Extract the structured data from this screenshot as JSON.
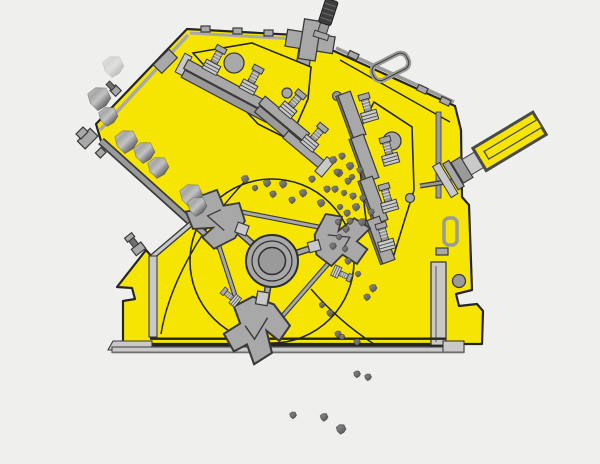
{
  "scene": {
    "width": 600,
    "height": 464,
    "description": "impact-crusher cross-section illustration",
    "background": "#efefee"
  },
  "colors": {
    "body_yellow": "#f6e502",
    "outline": "#252525",
    "metal": "#a8a8a8",
    "metal_light": "#c9c9c9",
    "metal_mid": "#9a9a9a",
    "metal_dark": "#6f6f6f",
    "metal_stroke": "#3a3a3a",
    "rod_dark": "#3d3d3d",
    "rock_light": "#d0d0d0",
    "rock_mid": "#a0a0a0",
    "rock_dark": "#4e4e4e",
    "particle_light": "#8f8f8f",
    "particle_dark": "#555555"
  },
  "feed_rocks": [
    {
      "x": 113,
      "y": 66,
      "r": 11,
      "o": 0.35
    },
    {
      "x": 99,
      "y": 98,
      "r": 12,
      "o": 1
    },
    {
      "x": 108,
      "y": 116,
      "r": 10,
      "o": 1
    },
    {
      "x": 126,
      "y": 141,
      "r": 12,
      "o": 1
    },
    {
      "x": 144,
      "y": 152,
      "r": 11,
      "o": 1
    },
    {
      "x": 158,
      "y": 167,
      "r": 11,
      "o": 1
    },
    {
      "x": 191,
      "y": 195,
      "r": 12,
      "o": 1
    },
    {
      "x": 197,
      "y": 206,
      "r": 10,
      "o": 1
    }
  ],
  "chamber_particles": [
    {
      "x": 245,
      "y": 179,
      "r": 4
    },
    {
      "x": 255,
      "y": 188,
      "r": 3
    },
    {
      "x": 267,
      "y": 183,
      "r": 4
    },
    {
      "x": 273,
      "y": 194,
      "r": 3.5
    },
    {
      "x": 283,
      "y": 184,
      "r": 4
    },
    {
      "x": 292,
      "y": 200,
      "r": 3.5
    },
    {
      "x": 303,
      "y": 193,
      "r": 4
    },
    {
      "x": 312,
      "y": 179,
      "r": 3.5
    },
    {
      "x": 321,
      "y": 203,
      "r": 4
    },
    {
      "x": 327,
      "y": 189,
      "r": 3.5
    },
    {
      "x": 339,
      "y": 173,
      "r": 4
    },
    {
      "x": 348,
      "y": 181,
      "r": 3.5
    },
    {
      "x": 356,
      "y": 207,
      "r": 4
    },
    {
      "x": 363,
      "y": 198,
      "r": 3.5
    },
    {
      "x": 350,
      "y": 221,
      "r": 3.5
    },
    {
      "x": 362,
      "y": 222,
      "r": 4
    },
    {
      "x": 371,
      "y": 212,
      "r": 3.5
    },
    {
      "x": 333,
      "y": 160,
      "r": 4
    },
    {
      "x": 342,
      "y": 156,
      "r": 3.5
    },
    {
      "x": 350,
      "y": 166,
      "r": 4
    },
    {
      "x": 337,
      "y": 172,
      "r": 3.5
    },
    {
      "x": 352,
      "y": 177,
      "r": 3
    },
    {
      "x": 360,
      "y": 170,
      "r": 3.5
    },
    {
      "x": 335,
      "y": 189,
      "r": 3.5
    },
    {
      "x": 344,
      "y": 193,
      "r": 3
    },
    {
      "x": 353,
      "y": 196,
      "r": 3.5
    },
    {
      "x": 340,
      "y": 207,
      "r": 3
    },
    {
      "x": 347,
      "y": 213,
      "r": 3.5
    },
    {
      "x": 338,
      "y": 222,
      "r": 3
    },
    {
      "x": 346,
      "y": 229,
      "r": 3.5
    },
    {
      "x": 339,
      "y": 237,
      "r": 3
    },
    {
      "x": 333,
      "y": 246,
      "r": 3.5
    },
    {
      "x": 345,
      "y": 249,
      "r": 3
    },
    {
      "x": 348,
      "y": 261,
      "r": 3.5
    },
    {
      "x": 358,
      "y": 274,
      "r": 3
    },
    {
      "x": 373,
      "y": 288,
      "r": 4
    },
    {
      "x": 367,
      "y": 297,
      "r": 3.5
    },
    {
      "x": 330,
      "y": 313,
      "r": 3.5
    },
    {
      "x": 322,
      "y": 305,
      "r": 3
    },
    {
      "x": 338,
      "y": 334,
      "r": 3.5
    },
    {
      "x": 357,
      "y": 342,
      "r": 3.5
    },
    {
      "x": 342,
      "y": 337,
      "r": 3
    }
  ],
  "falling_particles": [
    {
      "x": 357,
      "y": 374,
      "r": 3.5
    },
    {
      "x": 368,
      "y": 377,
      "r": 3.5
    },
    {
      "x": 293,
      "y": 415,
      "r": 3.5
    },
    {
      "x": 324,
      "y": 417,
      "r": 4
    },
    {
      "x": 341,
      "y": 429,
      "r": 5
    }
  ]
}
